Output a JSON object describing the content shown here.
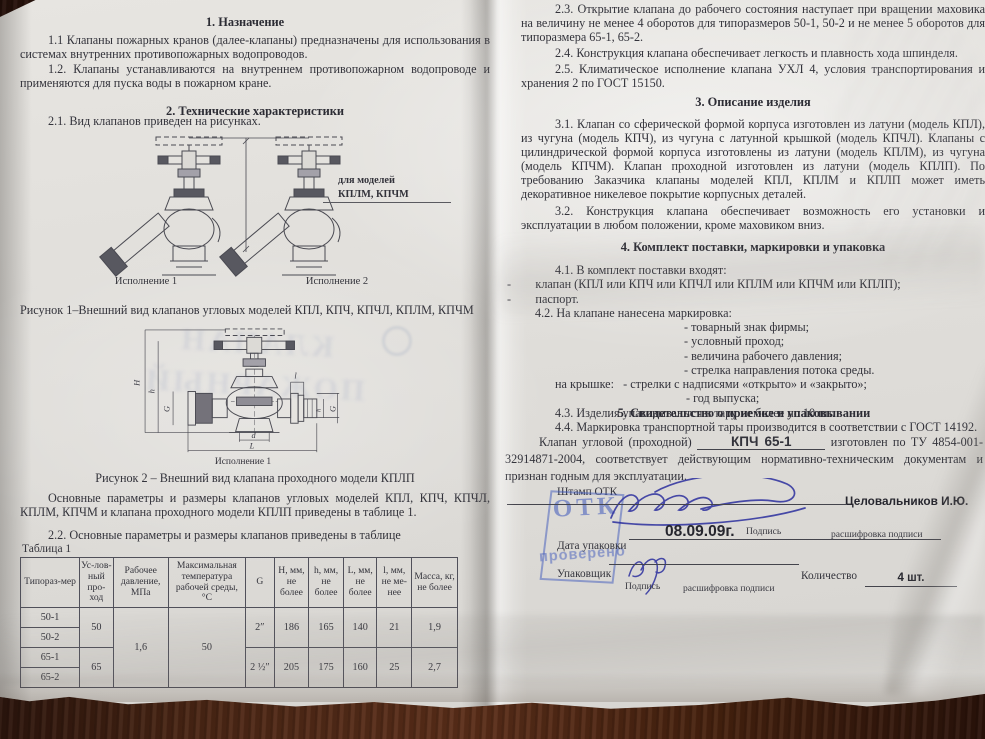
{
  "left": {
    "s1_title": "1. Назначение",
    "p11": "1.1 Клапаны пожарных кранов (далее-клапаны) предназначены для использования в системах внутренних противопожарных водопроводов.",
    "p12": "1.2. Клапаны устанавливаются на внутреннем противопожарном водопроводе и применяются для пуска воды в пожарном кране.",
    "s2_title": "2. Технические характеристики",
    "p21": "2.1. Вид клапанов приведен на рисунках.",
    "fig1": {
      "annotation_l1": "для моделей",
      "annotation_l2": "КПЛМ, КПЧМ",
      "caption1": "Исполнение 1",
      "caption2": "Исполнение 2",
      "title": "Рисунок 1–Внешний вид клапанов угловых моделей КПЛ, КПЧ, КПЧЛ, КПЛМ, КПЧМ"
    },
    "fig2": {
      "caption": "Исполнение 1",
      "title": "Рисунок 2 – Внешний вид клапана проходного модели КПЛП",
      "dims": {
        "H": "H",
        "h": "h",
        "G": "G",
        "l": "l",
        "h2": "h",
        "G2": "G",
        "d": "d",
        "L": "L"
      }
    },
    "p_params": "Основные параметры и размеры клапанов угловых моделей КПЛ, КПЧ, КПЧЛ, КПЛМ, КПЧМ и клапана проходного модели КПЛП приведены в таблице 1.",
    "p22": "2.2. Основные параметры и размеры клапанов приведены в таблице",
    "table_label": "Таблица 1",
    "table": {
      "h": [
        "Типораз-мер",
        "Ус-лов-ный про-ход",
        "Рабочее давление, МПа",
        "Максимальная температура рабочей среды, °С",
        "G",
        "H, мм, не более",
        "h, мм, не более",
        "L, мм, не более",
        "l, мм, не ме-нее",
        "Масса, кг, не более"
      ],
      "rows": [
        "50-1",
        "50-2",
        "65-1",
        "65-2"
      ],
      "dn": [
        "50",
        "65"
      ],
      "pressure": "1,6",
      "temp": "50",
      "g": [
        "2″",
        "2 ½″"
      ],
      "H": [
        "186",
        "205"
      ],
      "hh": [
        "165",
        "175"
      ],
      "L": [
        "140",
        "160"
      ],
      "l": [
        "21",
        "25"
      ],
      "mass": [
        "1,9",
        "2,7"
      ]
    },
    "watermark_l1": "КЛАПАН",
    "watermark_l2": "ПОЖАРНЫЙ"
  },
  "right": {
    "p23": "2.3. Открытие клапана до рабочего состояния наступает при вращении маховика на величину не менее 4 оборотов для типоразмеров 50-1, 50-2 и не менее 5 оборотов для типоразмера 65-1, 65-2.",
    "p24": "2.4. Конструкция клапана обеспечивает легкость и плавность хода шпинделя.",
    "p25": "2.5. Климатическое исполнение клапана УХЛ 4, условия транспортирования и хранения 2 по ГОСТ 15150.",
    "s3_title": "3. Описание изделия",
    "p31": "3.1. Клапан со сферической формой корпуса изготовлен из латуни (модель КПЛ), из чугуна (модель КПЧ), из чугуна с латунной крышкой (модель КПЧЛ). Клапаны с цилиндрической формой корпуса изготовлены из латуни (модель КПЛМ), из чугуна (модель КПЧМ). Клапан проходной изготовлен из латуни (модель КПЛП). По требованию Заказчика клапаны моделей КПЛ, КПЛМ и КПЛП может иметь декоративное никелевое покрытие корпусных деталей.",
    "p32": "3.2. Конструкция клапана обеспечивает возможность его установки и эксплуатации в любом положении, кроме маховиком вниз.",
    "s4_title": "4. Комплект поставки, маркировки и упаковка",
    "p41": "4.1. В комплект поставки входят:",
    "li1": "-        клапан (КПЛ или КПЧ или КПЧЛ или КПЛМ или КПЧМ или КПЛП);",
    "li2": "-        паспорт.",
    "p42": "4.2. На клапане нанесена маркировка:",
    "m1": "- товарный знак фирмы;",
    "m2": "- условный проход;",
    "m3": "- величина рабочего давления;",
    "m4": "- стрелка направления потока среды.",
    "lid": "на крышке:   - стрелки с надписями «открыто» и «закрыто»;",
    "m5": "- год выпуска;",
    "p43": "4.3. Изделия упаковываются в тару не более по 10 шт.",
    "p44": "4.4. Маркировка транспортной тары производится в соответствии с ГОСТ 14192.",
    "s5_title": "5. Свидетельство о приемке и упаковывании",
    "acceptance": {
      "prefix": "Клапан угловой (проходной)",
      "model": "КПЧ 65-1",
      "suffix": "изготовлен по ТУ 4854-001-32914871-2004, соответствует действующим нормативно-техническим документам и признан годным для эксплуатации."
    },
    "stamp": {
      "label": "Штамп ОТК",
      "otk": "ОТК",
      "checked": "проверено"
    },
    "sig": {
      "inspector": "Целовальников И.Ю.",
      "sign_label": "Подпись",
      "decode_label": "расшифровка подписи"
    },
    "pack": {
      "date_label": "Дата упаковки",
      "date_value": "08.09.09г.",
      "packer_label": "Упаковщик",
      "qty_label": "Количество",
      "qty_value": "4 шт."
    }
  }
}
